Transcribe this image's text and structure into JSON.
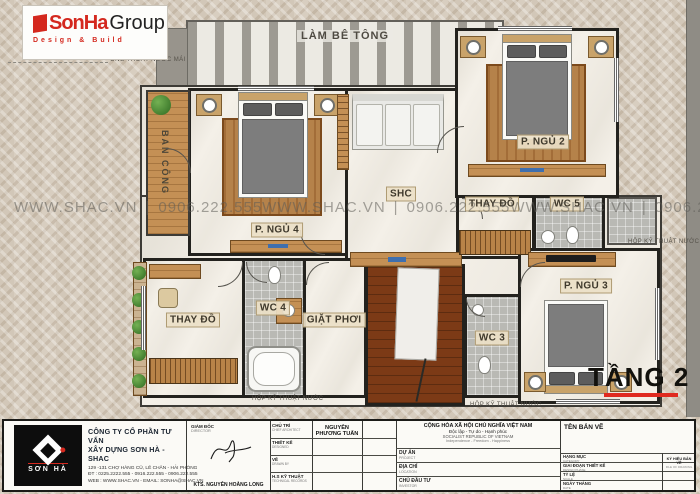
{
  "logo": {
    "brand_primary": "SonHa",
    "brand_secondary": "Group",
    "tagline": "Design & Build"
  },
  "plan": {
    "floor_label": "TẦNG 2",
    "rooms": {
      "lam_be_tong": "LÀM BÊ TÔNG",
      "ban_cong": "BAN CÔNG",
      "p_ngu_2": "P. NGỦ 2",
      "p_ngu_3": "P. NGỦ 3",
      "p_ngu_4": "P. NGỦ 4",
      "shc": "SHC",
      "thay_do": "THAY ĐỒ",
      "wc_3": "WC 3",
      "wc_4": "WC 4",
      "wc_5": "WC 5",
      "giat_phoi": "GIẶT PHƠI"
    },
    "annotations": {
      "ong_thoat_nuoc_mai": "ỐNG THOÁT NƯỚC MÁI",
      "hop_ky_thuat_nuoc": "HỘP KỸ THUẬT NƯỚC"
    },
    "watermark": {
      "site": "WWW.SHAC.VN",
      "sep": "|",
      "phone": "0906.222.555"
    }
  },
  "title_block": {
    "company": {
      "logo_text": "SƠN HÀ",
      "name_line1": "CÔNG TY CỔ PHẦN TƯ VẤN",
      "name_line2": "XÂY DỰNG SƠN HÀ - SHAC",
      "address": "129 -131  CHỢ HÀNG CŨ,  LÊ CHÂN - HẢI PHÒNG",
      "phone": "ĐT : 0225.2222.555 - 0916.222.555 - 0906.222.555",
      "web": "WEB : WWW.SHAC.VN -  EMAIL: SONHA@SHAC.VN"
    },
    "director": {
      "label_vn": "GIÁM ĐỐC",
      "label_en": "DIRECTOR",
      "name": "KTS. NGUYỄN HOÀNG LONG"
    },
    "staff_rows": [
      {
        "vn": "CHỦ TRÌ",
        "en": "CHIEF ARCHITECT",
        "value": "NGUYỄN PHƯƠNG TUẤN"
      },
      {
        "vn": "THIẾT KẾ",
        "en": "DESIGNED",
        "value": ""
      },
      {
        "vn": "VẼ",
        "en": "DRAWN BY",
        "value": ""
      },
      {
        "vn": "H.S KỸ THUẬT",
        "en": "TECHNICAL RECORDS",
        "value": ""
      }
    ],
    "national": {
      "vn_line1": "CỘNG HÒA XÃ HỘI CHỦ NGHĨA VIỆT NAM",
      "vn_line2": "Độc lập - Tự do - Hạnh phúc",
      "en_line1": "SOCIALIST REPUBLIC OF VIETNAM",
      "en_line2": "Independence - Freedom - Happiness"
    },
    "project_rows": [
      {
        "vn": "DỰ ÁN",
        "en": "PROJECT"
      },
      {
        "vn": "ĐỊA CHỈ",
        "en": "LOCATION"
      },
      {
        "vn": "CHỦ ĐẦU TƯ",
        "en": "INVESTOR"
      }
    ],
    "drawing": {
      "title_label": "TÊN BẢN VẼ",
      "rows": [
        {
          "vn": "HẠNG MỤC",
          "en": "CATEGORY"
        },
        {
          "vn": "GIAI ĐOẠN THIẾT KẾ",
          "en": "DESIGN PHASE"
        },
        {
          "vn": "TỶ LỆ",
          "en": "SCALE"
        },
        {
          "vn": "NGÀY THÁNG",
          "en": "DATE"
        }
      ],
      "code_label_vn": "KÝ HIỆU BẢN VẼ",
      "code_label_en": "FILE OF DRAWING"
    }
  },
  "colors": {
    "accent_red": "#d4281e",
    "underline_red": "#e02a20"
  }
}
